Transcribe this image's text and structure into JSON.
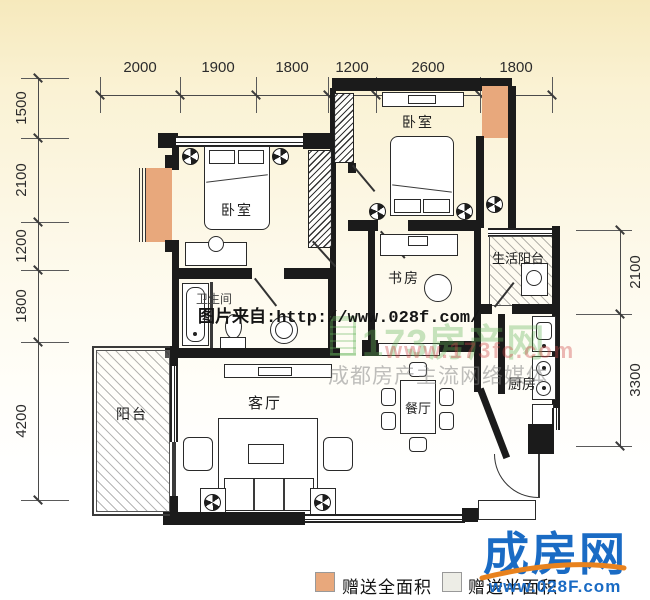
{
  "dimensions": {
    "top": {
      "labels": [
        "2000",
        "1900",
        "1800",
        "1200",
        "2600",
        "1800"
      ]
    },
    "left": {
      "labels": [
        "1500",
        "2100",
        "1200",
        "1800",
        "4200"
      ]
    },
    "right": {
      "labels": [
        "2100",
        "3300"
      ]
    }
  },
  "rooms": {
    "bedroom_left": "卧室",
    "bedroom_right": "卧室",
    "study": "书房",
    "service_balcony": "生活阳台",
    "bathroom": "卫生间",
    "living": "客厅",
    "dining": "餐厅",
    "kitchen": "厨房",
    "balcony": "阳台"
  },
  "watermarks": {
    "source": "图片来自:http://www.028f.com/",
    "agency_logo": "173房产网",
    "agency_url": "www.173fc.com",
    "agency_slogan": "成都房产主流网络媒体"
  },
  "branding": {
    "site_name": "成房网",
    "site_url": "www.028F.com"
  },
  "legend": {
    "full_area": "赠送全面积",
    "half_area": "赠送半面积"
  },
  "colors": {
    "gift_full_swatch": "#e8a87c",
    "gift_half_swatch": "#ededE6",
    "brand_blue": "#1a6bc4",
    "brand_orange": "#e8821e"
  }
}
